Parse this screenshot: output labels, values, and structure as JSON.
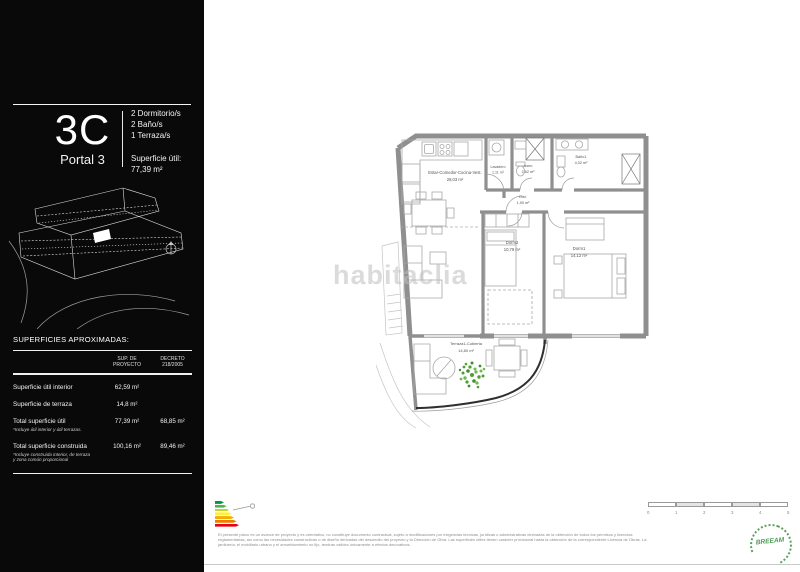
{
  "sidebar": {
    "unit_code": "3C",
    "portal": "Portal 3",
    "features": [
      "2 Dormitorio/s",
      "2 Baño/s",
      "1 Terraza/s"
    ],
    "superficie_label": "Superficie útil:",
    "superficie_value": "77,39 m²",
    "areas": {
      "title": "SUPERFICIES APROXIMADAS:",
      "col_proyecto": "SUP. DE\nPROYECTO",
      "col_decreto": "DECRETO\n218/2005",
      "rows": [
        {
          "label": "Superficie útil interior",
          "note": "",
          "proyecto": "62,59 m²",
          "decreto": ""
        },
        {
          "label": "Superficie de terraza",
          "note": "",
          "proyecto": "14,8 m²",
          "decreto": ""
        },
        {
          "label": "Total superficie útil",
          "note": "*Incluye útil interior y útil terrazas.",
          "proyecto": "77,39 m²",
          "decreto": "68,85 m²"
        },
        {
          "label": "Total superficie construida",
          "note": "*Incluye construida interior, de terraza y zona común proporcional",
          "proyecto": "100,16 m²",
          "decreto": "89,46 m²"
        }
      ]
    }
  },
  "floorplan": {
    "watermark": "habitaclia",
    "rooms": {
      "estar": {
        "name": "Estar-Comedor-Cocina-Vest.",
        "area": "28,03 m²"
      },
      "lavadero": {
        "name": "Lavadero",
        "area": "1,11 m²"
      },
      "aseo": {
        "name": "Aseo",
        "area": "2,62 m²"
      },
      "bano1": {
        "name": "Baño1",
        "area": "4,02 m²"
      },
      "dist": {
        "name": "Dist.",
        "area": "1,90 m²"
      },
      "dorm2": {
        "name": "Dorm2",
        "area": "10,79 m²"
      },
      "dorm1": {
        "name": "Dorm1",
        "area": "14,12 m²"
      },
      "terraza": {
        "name": "Terraza1-Cubierta",
        "area": "14,80 m²"
      }
    }
  },
  "energy_label": {
    "colors": [
      "#019641",
      "#4cb847",
      "#bed630",
      "#fff12c",
      "#f8ac00",
      "#ef7d00",
      "#e30613"
    ]
  },
  "footer": {
    "disclaimer": [
      "El presente plano es un avance de proyecto y es orientativo, no constituye documento contractual, sujeto a modificaciones por exigencias técnicas, jurídicas o administrativas derivadas de la obtención de todos los permisos y licencias",
      "reglamentarias, así como las necesidades constructivas o de diseño derivadas del desarrollo del proyecto y la Dirección de Obra. Las superficies útiles tienen carácter provisional hasta la obtención de la correspondiente Licencia de Obras. La",
      "jardinería, el mobiliario urbano y el amueblamiento no fijo, tendrán validez únicamente a efectos decorativos."
    ],
    "scale_ticks": [
      "0",
      "1",
      "2",
      "3",
      "4",
      "5"
    ],
    "breeam_label": "BREEAM"
  }
}
